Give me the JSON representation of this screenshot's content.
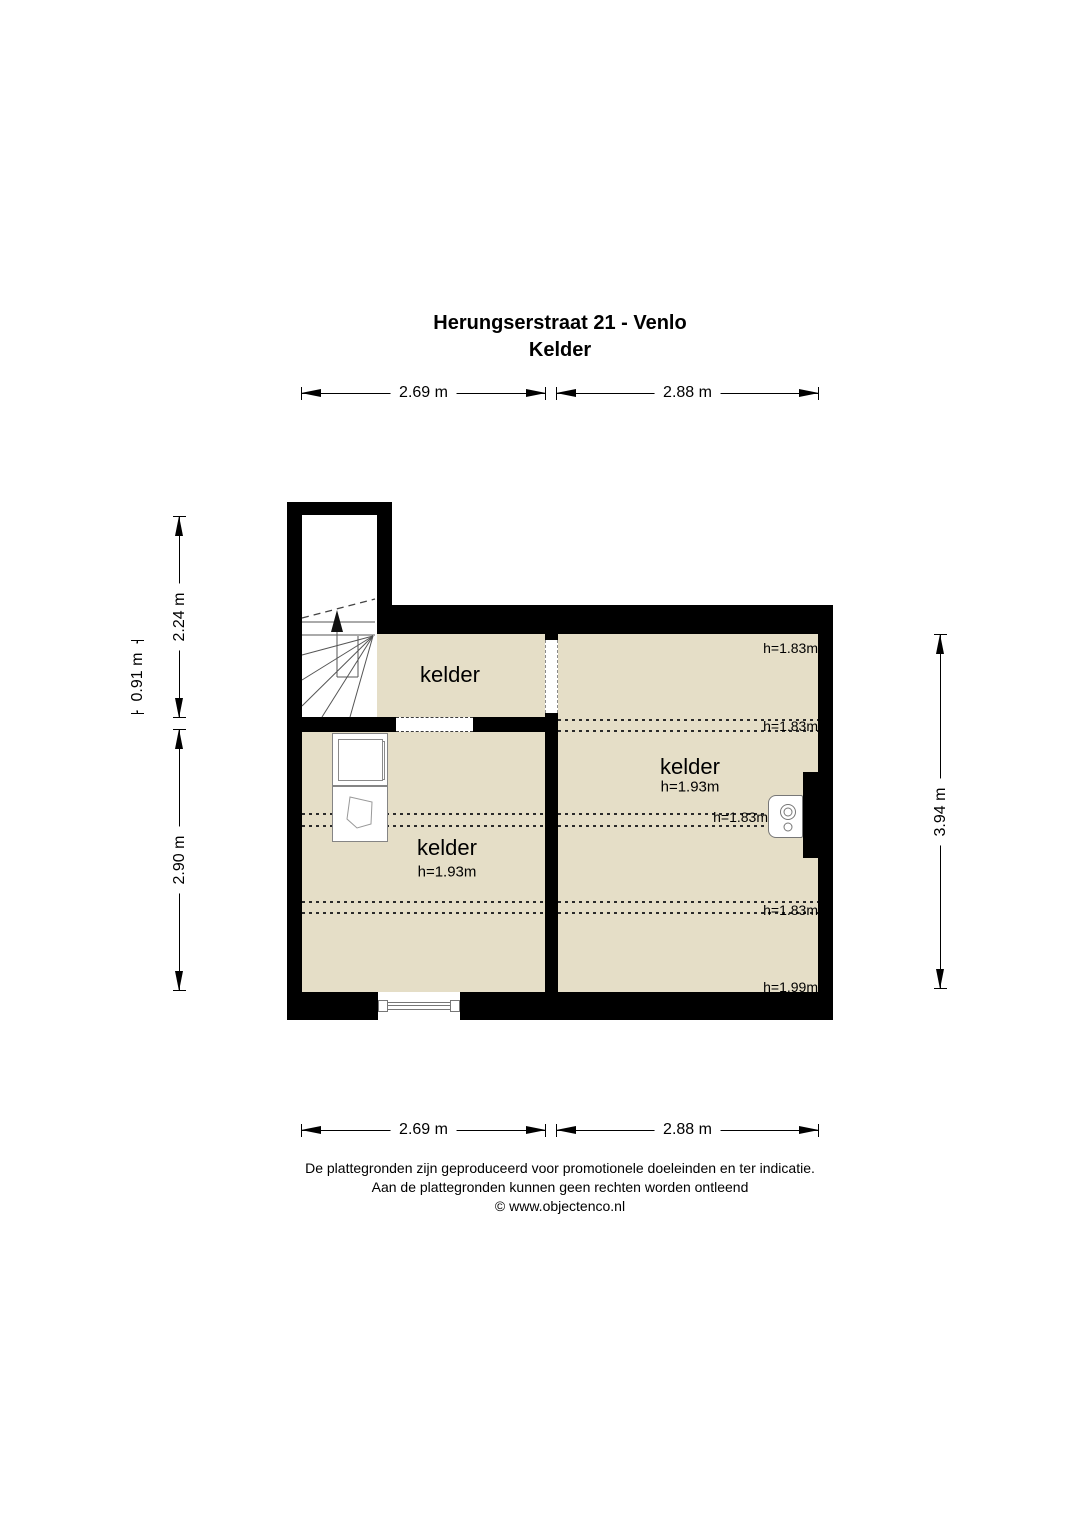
{
  "title": {
    "line1": "Herungserstraat 21 - Venlo",
    "line2": "Kelder"
  },
  "dims": {
    "top_left": "2.69 m",
    "top_right": "2.88 m",
    "bottom_left": "2.69 m",
    "bottom_right": "2.88 m",
    "left_upper": "2.24 m",
    "left_small": "0.91 m",
    "left_lower": "2.90 m",
    "right": "3.94 m"
  },
  "rooms": {
    "top": {
      "label": "kelder"
    },
    "left": {
      "label": "kelder",
      "height": "h=1.93m"
    },
    "right": {
      "label": "kelder",
      "height": "h=1.93m"
    }
  },
  "markers": {
    "m1": "h=1.83m",
    "m2": "h=1.83m",
    "m3": "h=1.83m",
    "m4": "h=1.83m",
    "m5": "h=1.99m"
  },
  "footer": {
    "line1": "De plattegronden zijn geproduceerd voor promotionele doeleinden en ter indicatie.",
    "line2": "Aan de plattegronden kunnen geen rechten worden ontleend",
    "line3": "© www.objectenco.nl"
  },
  "colors": {
    "floor": "#e5dec7",
    "wall": "#000000"
  }
}
